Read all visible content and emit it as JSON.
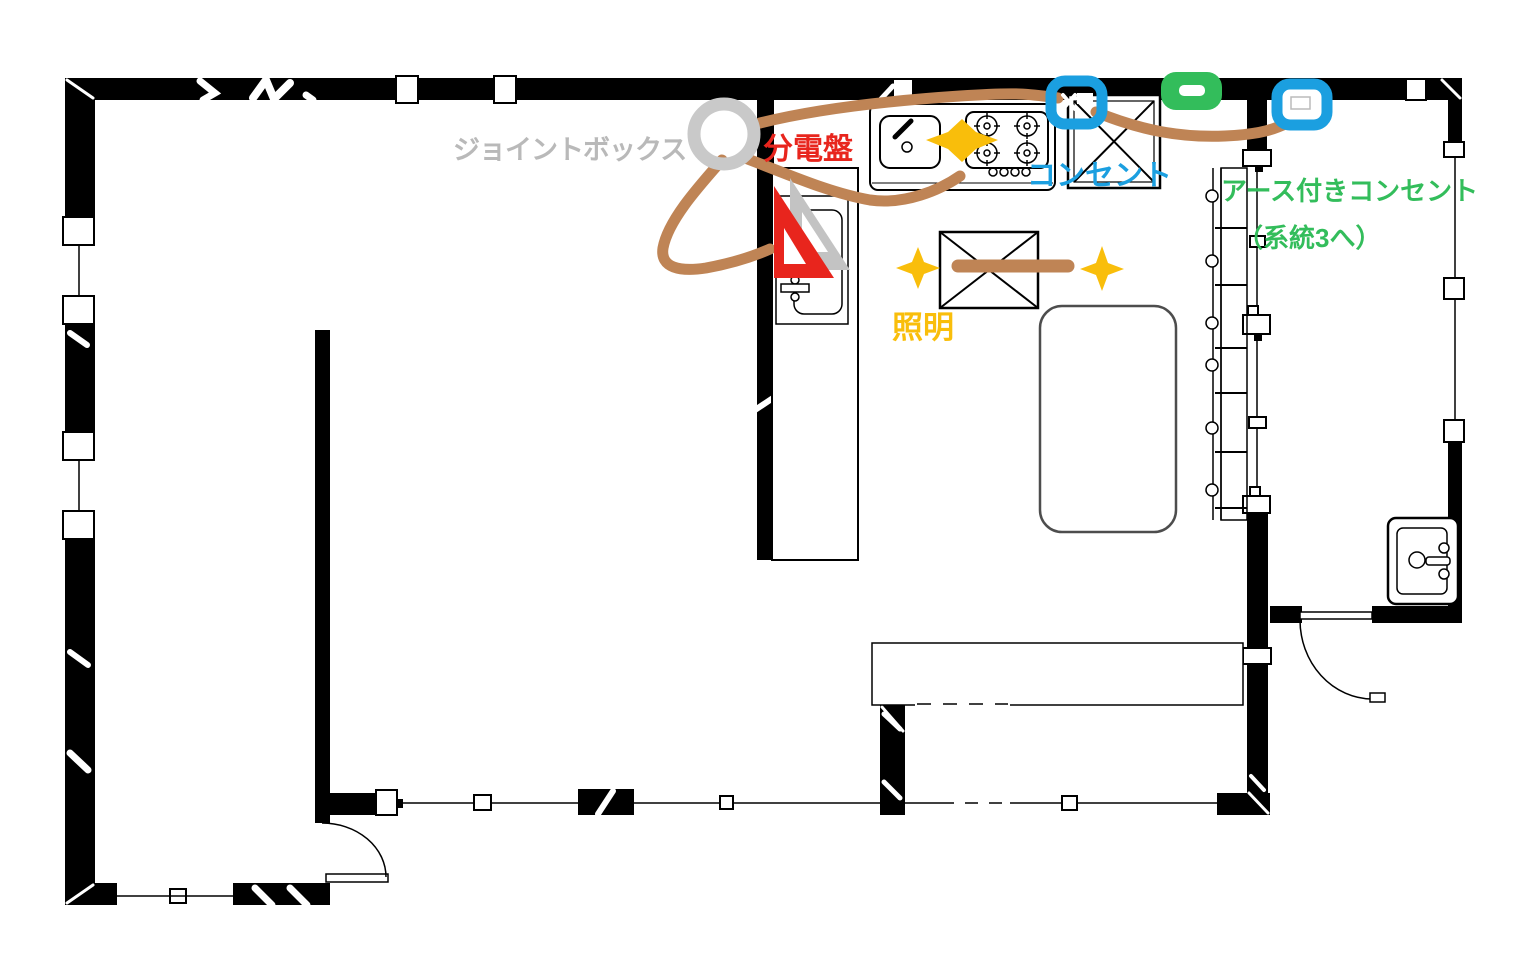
{
  "title": "kitchen electrical wiring floor plan",
  "canvas": {
    "width": 1536,
    "height": 977,
    "background": "#ffffff"
  },
  "labels": {
    "joint_box": "ジョイントボックス",
    "distribution_board": "分電盤",
    "outlet": "コンセント",
    "grounded_outlet": "アース付きコンセント",
    "grounded_outlet_note": "（系統3へ）",
    "lighting": "照明"
  },
  "colors": {
    "joint_box_symbol": "#c9c9c9",
    "joint_box_label": "#b9b9b9",
    "distribution_board": "#e8251d",
    "outlet_blue": "#1b9fe0",
    "grounded_outlet_green": "#33bd5b",
    "lighting_yellow": "#f9be0b",
    "wiring_brown": "#bf8455",
    "walls": "#000000",
    "set_square_gray": "#c3c3c3"
  },
  "symbols": {
    "joint_box": "gray-ring-circle",
    "distribution_board": "red-and-gray-set-squares",
    "outlet_markers_count": 2,
    "grounded_outlet_marker": "green-rounded-badge-with-dash",
    "lighting_markers": [
      "four-point-diamond",
      "sparkle-left",
      "sparkle-right"
    ],
    "wire_segments_count": 5
  },
  "fixtures": [
    "kitchen-sink",
    "gas-stove",
    "refrigerator",
    "range-hood",
    "island-counter",
    "vanity-cabinet",
    "tall-cabinet",
    "dining-counter",
    "washbasin",
    "door-bottom-left",
    "door-washroom"
  ]
}
